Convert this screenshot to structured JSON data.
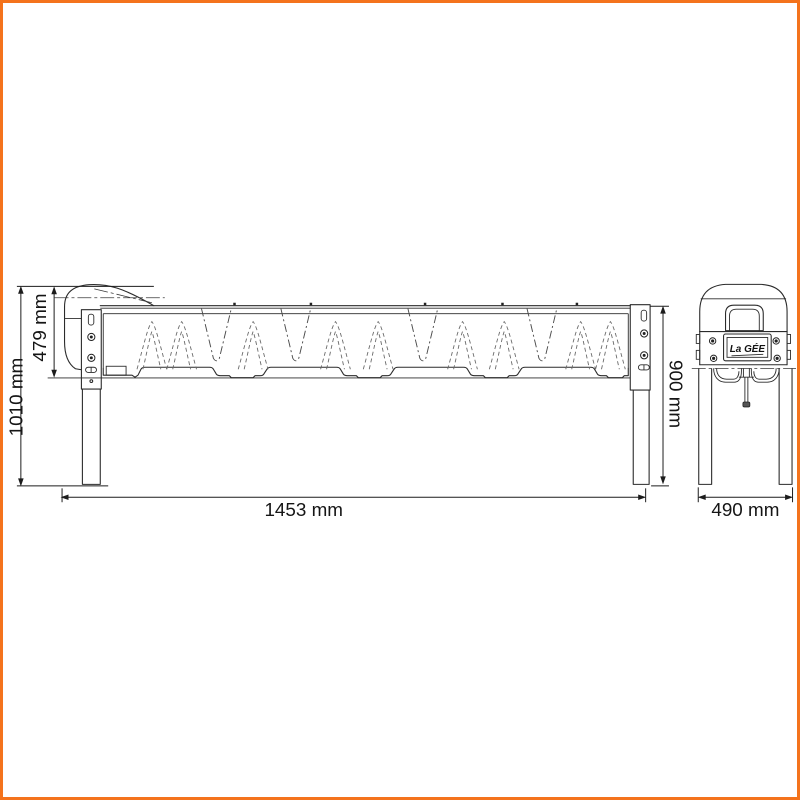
{
  "frame": {
    "color": "#f4731c",
    "background": "#ffffff"
  },
  "drawing": {
    "logo_text": "La GÉE",
    "dimensions": {
      "overall_height": {
        "label": "1010 mm",
        "value": 1010,
        "unit": "mm"
      },
      "trough_height": {
        "label": "479 mm",
        "value": 479,
        "unit": "mm"
      },
      "leg_height": {
        "label": "900 mm",
        "value": 900,
        "unit": "mm"
      },
      "overall_length": {
        "label": "1453 mm",
        "value": 1453,
        "unit": "mm"
      },
      "overall_width": {
        "label": "490 mm",
        "value": 490,
        "unit": "mm"
      }
    }
  }
}
